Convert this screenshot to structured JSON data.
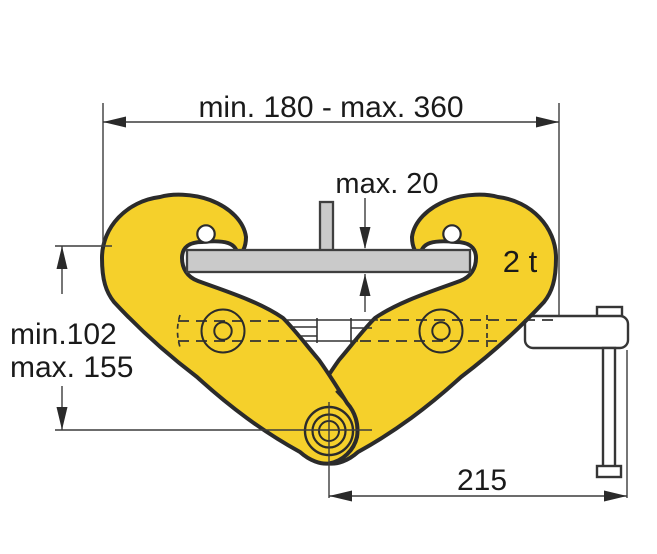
{
  "diagram": {
    "type": "technical-drawing",
    "subject": "beam clamp side view clamped on I-beam flange",
    "capacity_label": "2 t",
    "dimensions": {
      "clamping_range": "min. 180 - max. 360",
      "flange_thickness": "max. 20",
      "height_min": "min.102",
      "height_max": "max. 155",
      "side_offset": "215"
    },
    "colors": {
      "clamp_body": "#F5D02B",
      "outline": "#2B2B2B",
      "beam_section": "#CACACA",
      "hardware": "#FFFFFF",
      "dimension_lines": "#3C3C3C",
      "text": "#1A1A1A",
      "background": "#FFFFFF"
    }
  }
}
